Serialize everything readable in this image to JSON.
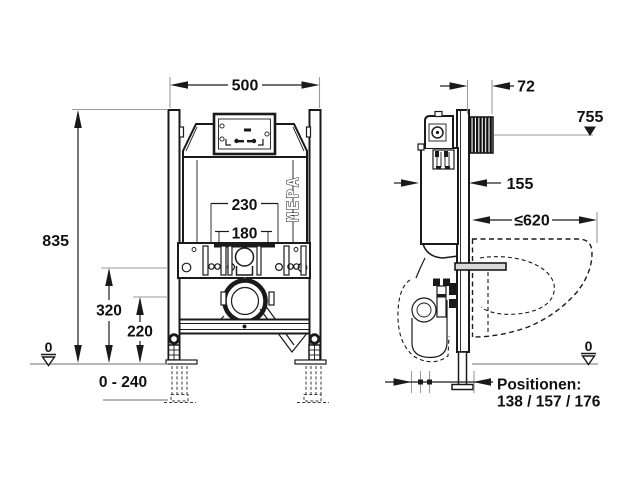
{
  "diagram": {
    "title": "wc-installation-frame-dimension-drawing",
    "logo": "MEPA",
    "front": {
      "width": "500",
      "height": "835",
      "spacing_outer": "230",
      "spacing_inner": "180",
      "plate_height": "320",
      "outlet_height": "220",
      "leg_range": "0 - 240",
      "datum": "0"
    },
    "side": {
      "wall_thickness": "72",
      "top_height": "755",
      "depth": "155",
      "bowl_depth": "≤620",
      "datum": "0",
      "positions_label": "Positionen:",
      "positions_values": "138 / 157 / 176"
    },
    "colors": {
      "line": "#1a1a1a",
      "extension_line": "#9a9a9a",
      "background": "#ffffff"
    }
  }
}
